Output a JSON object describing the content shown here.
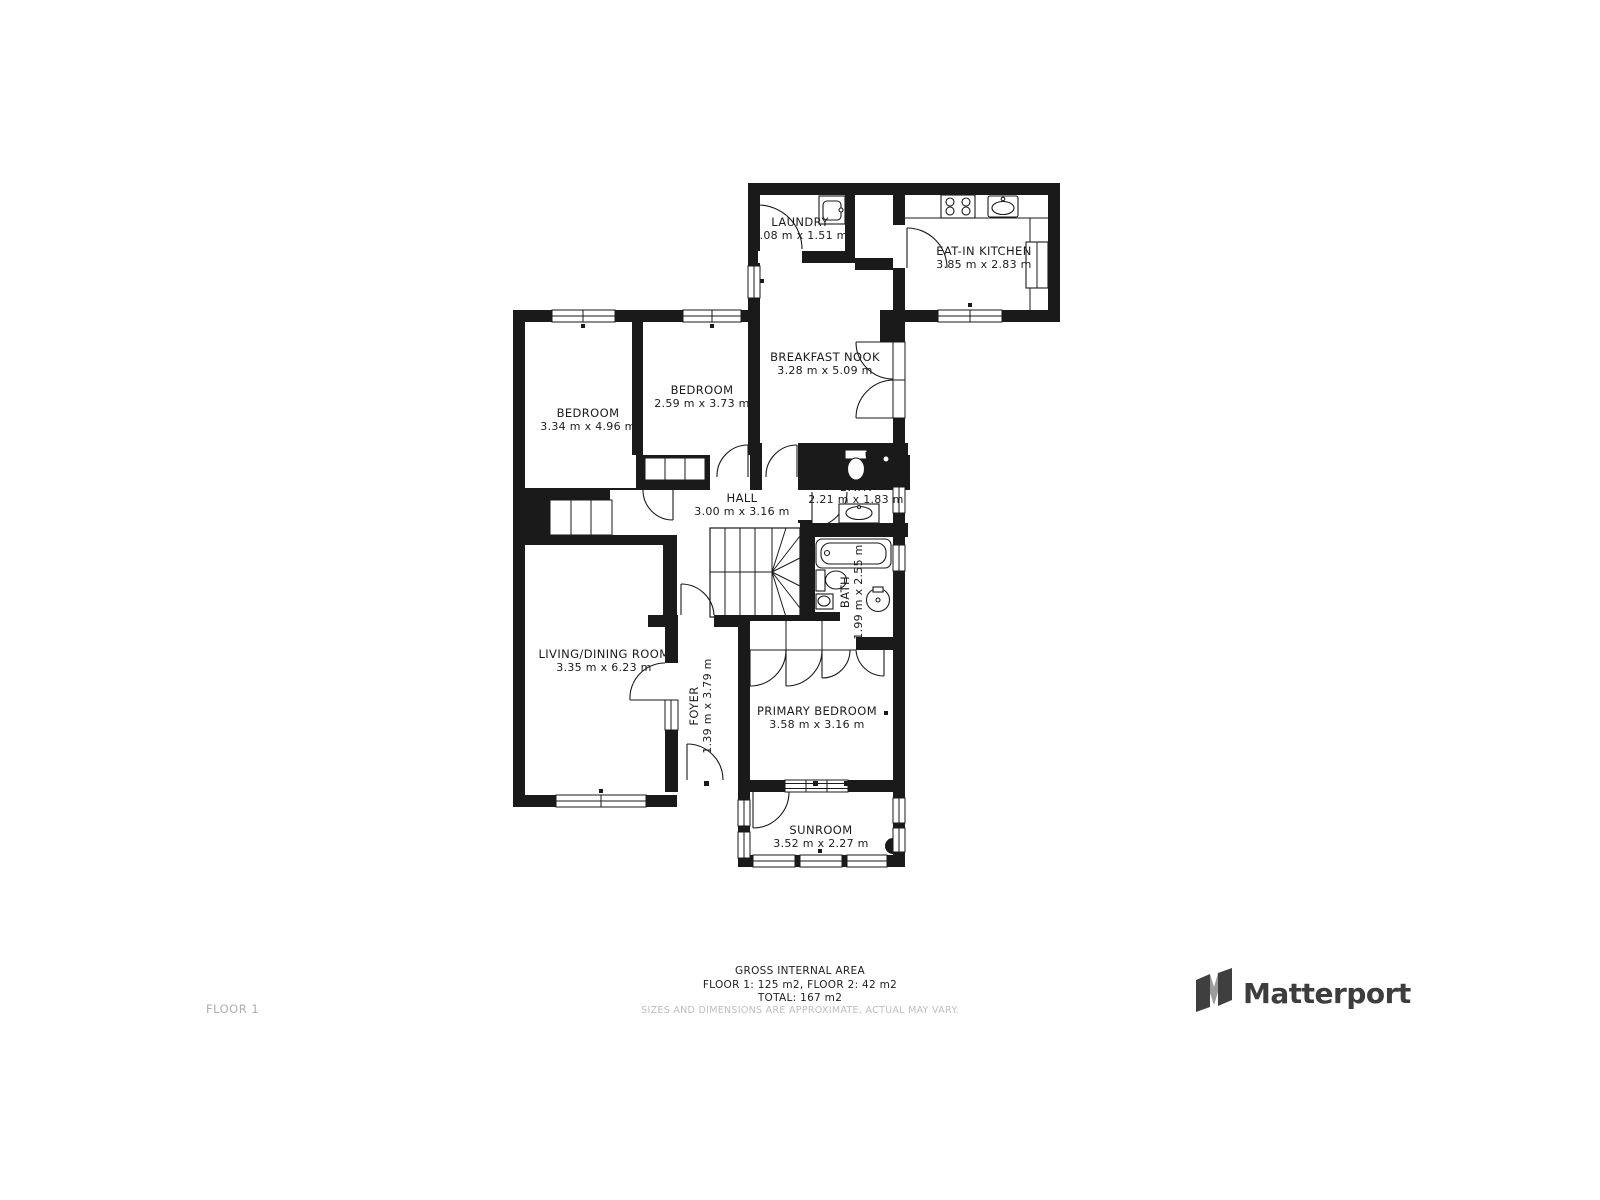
{
  "floor_label": "FLOOR 1",
  "rooms": [
    {
      "id": "laundry",
      "name": "LAUNDRY",
      "dims": "2.08 m x 1.51 m"
    },
    {
      "id": "kitchen",
      "name": "EAT-IN KITCHEN",
      "dims": "3.85 m x 2.83 m"
    },
    {
      "id": "nook",
      "name": "BREAKFAST NOOK",
      "dims": "3.28 m x 5.09 m"
    },
    {
      "id": "bedroom2",
      "name": "BEDROOM",
      "dims": "2.59 m x 3.73 m"
    },
    {
      "id": "bedroom1",
      "name": "BEDROOM",
      "dims": "3.34 m x 4.96 m"
    },
    {
      "id": "hall",
      "name": "HALL",
      "dims": "3.00 m x 3.16 m"
    },
    {
      "id": "bath1",
      "name": "BATH",
      "dims": "2.21 m x 1.83 m"
    },
    {
      "id": "bath2",
      "name": "BATH",
      "dims": "1.99 m x 2.55 m"
    },
    {
      "id": "living",
      "name": "LIVING/DINING ROOM",
      "dims": "3.35 m x 6.23 m"
    },
    {
      "id": "foyer",
      "name": "FOYER",
      "dims": "1.39 m x 3.79 m"
    },
    {
      "id": "primary",
      "name": "PRIMARY BEDROOM",
      "dims": "3.58 m x 3.16 m"
    },
    {
      "id": "sunroom",
      "name": "SUNROOM",
      "dims": "3.52 m x 2.27 m"
    }
  ],
  "footer": {
    "title": "GROSS INTERNAL AREA",
    "floors": "FLOOR 1: 125 m2, FLOOR 2: 42 m2",
    "total": "TOTAL: 167 m2",
    "disclaimer": "SIZES AND DIMENSIONS ARE APPROXIMATE, ACTUAL MAY VARY."
  },
  "brand": {
    "name": "Matterport"
  },
  "colors": {
    "wall": "#1a1a1a",
    "background": "#ffffff",
    "muted_text": "#bdbdbd",
    "brand_text": "#3d3d3d"
  }
}
